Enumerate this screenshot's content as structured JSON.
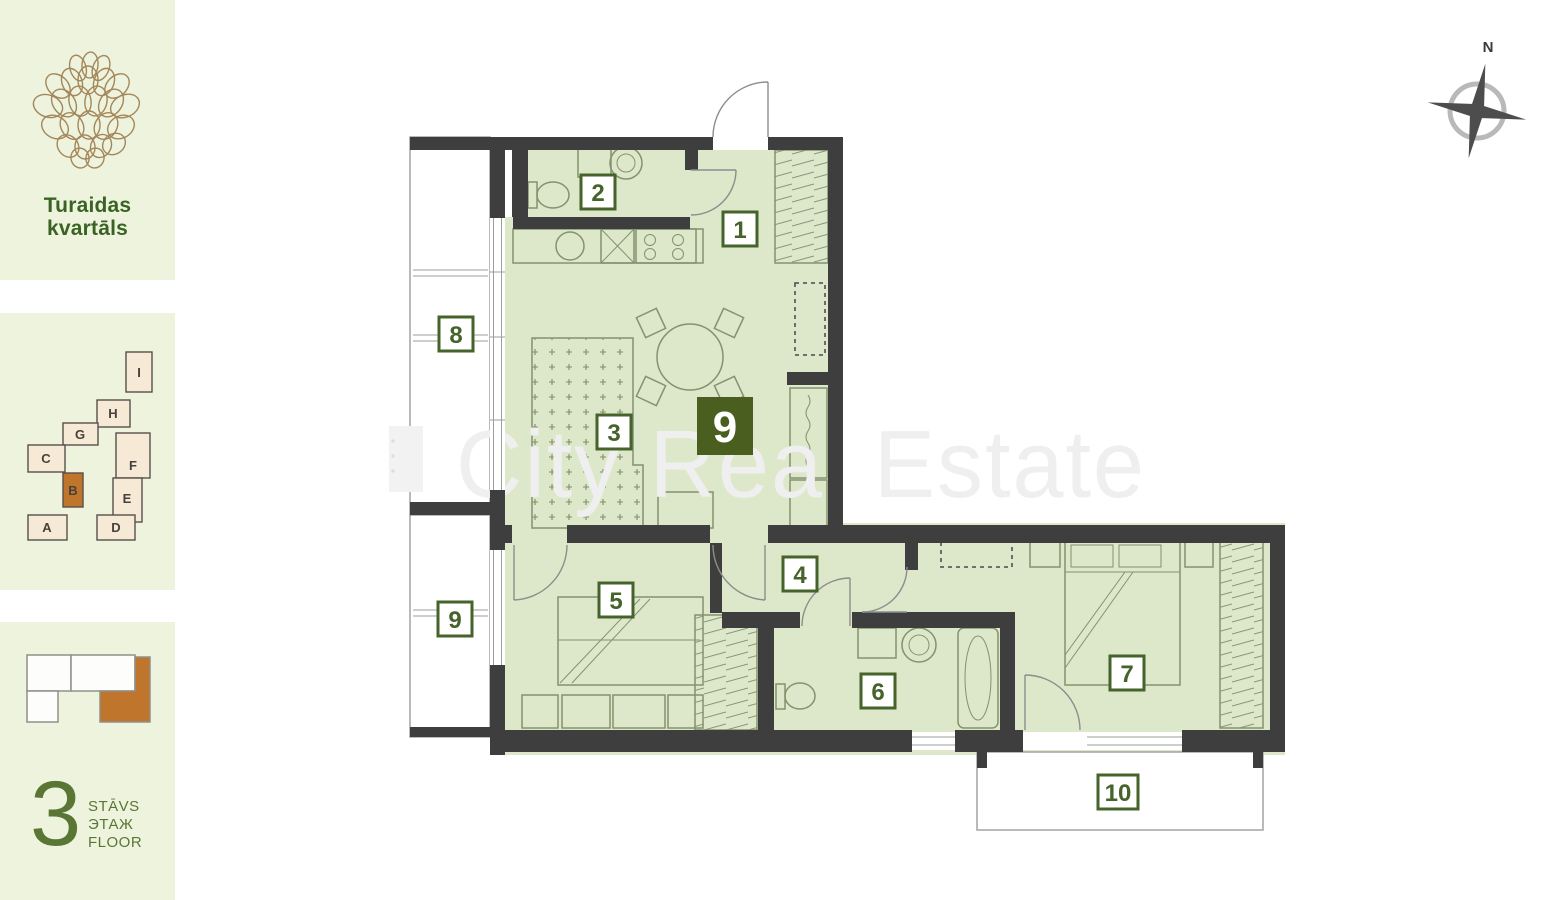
{
  "branding": {
    "project_name_line1": "Turaidas",
    "project_name_line2": "kvartāls"
  },
  "site_plan": {
    "blocks": [
      {
        "label": "I"
      },
      {
        "label": "H"
      },
      {
        "label": "G"
      },
      {
        "label": "C"
      },
      {
        "label": "B"
      },
      {
        "label": "F"
      },
      {
        "label": "E"
      },
      {
        "label": "A"
      },
      {
        "label": "D"
      }
    ],
    "highlighted_block": "B"
  },
  "floor_indicator": {
    "number": "3",
    "label_lv": "STĀVS",
    "label_ru": "ЭТАЖ",
    "label_en": "FLOOR"
  },
  "floor_plan": {
    "apartment_number": "9",
    "rooms": [
      {
        "number": "1"
      },
      {
        "number": "2"
      },
      {
        "number": "3"
      },
      {
        "number": "4"
      },
      {
        "number": "5"
      },
      {
        "number": "6"
      },
      {
        "number": "7"
      }
    ],
    "balconies": [
      {
        "number": "8"
      },
      {
        "number": "9"
      },
      {
        "number": "10"
      }
    ]
  },
  "compass": {
    "north_label": "N"
  },
  "watermark": {
    "text": "City Real Estate"
  },
  "colors": {
    "wall": "#3e3e3e",
    "room_fill": "#dde7c9",
    "label_green": "#45632a",
    "apartment_badge": "#4a5e1f",
    "accent_orange": "#c0752d",
    "sidebar_bg": "#eef3de",
    "brand_green": "#3a6323",
    "block_fill": "#f6ead7"
  }
}
